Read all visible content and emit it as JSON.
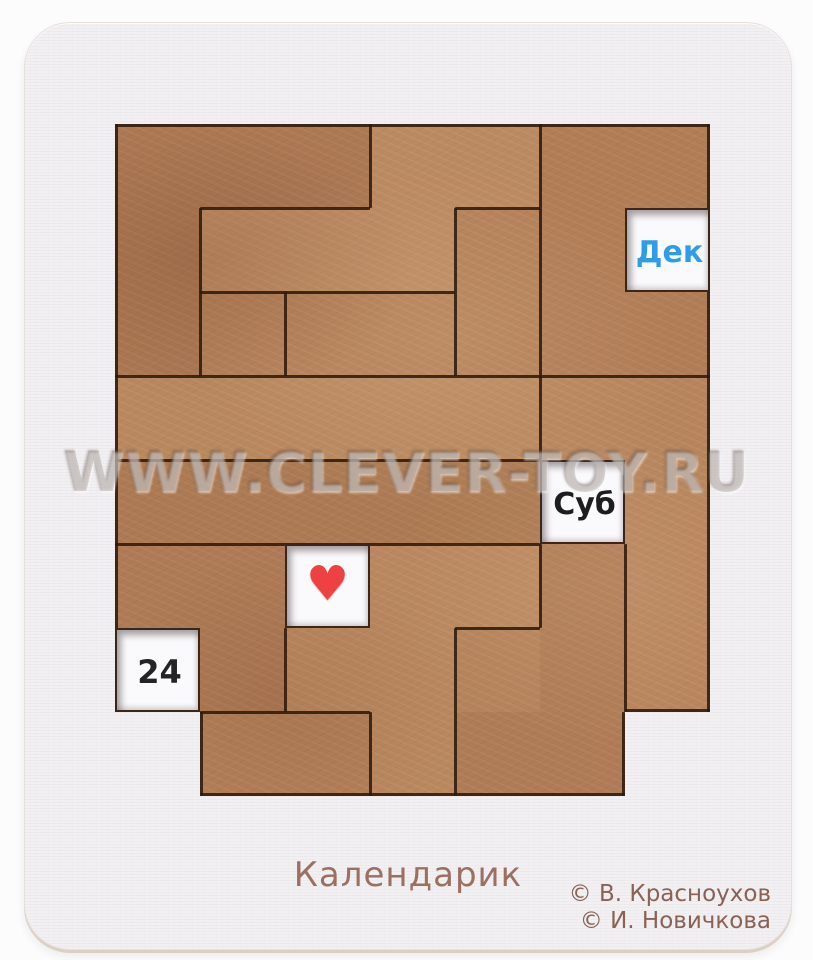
{
  "photo": {
    "product_title": "Календарик",
    "copyright": [
      "© В. Красноухов",
      "© И. Новичкова"
    ],
    "watermark": "WWW.CLEVER-TOY.RU"
  },
  "puzzle": {
    "grid": {
      "cols": 7,
      "rows": 8
    },
    "windows": [
      {
        "name": "month-window",
        "label": "Дек",
        "color": "#2f9ce8",
        "col": 6,
        "row": 1
      },
      {
        "name": "weekday-window",
        "label": "Суб",
        "color": "#1d1d1f",
        "col": 5,
        "row": 4
      },
      {
        "name": "day-window",
        "label": "24",
        "color": "#242426",
        "col": 0,
        "row": 6
      },
      {
        "name": "heart-window",
        "label": "♥",
        "color": "#ee4143",
        "col": 2,
        "row": 5
      }
    ],
    "piece_color": "#b28059",
    "seam_color": "#2e1a0d",
    "board_color": "#f2f0f3"
  }
}
